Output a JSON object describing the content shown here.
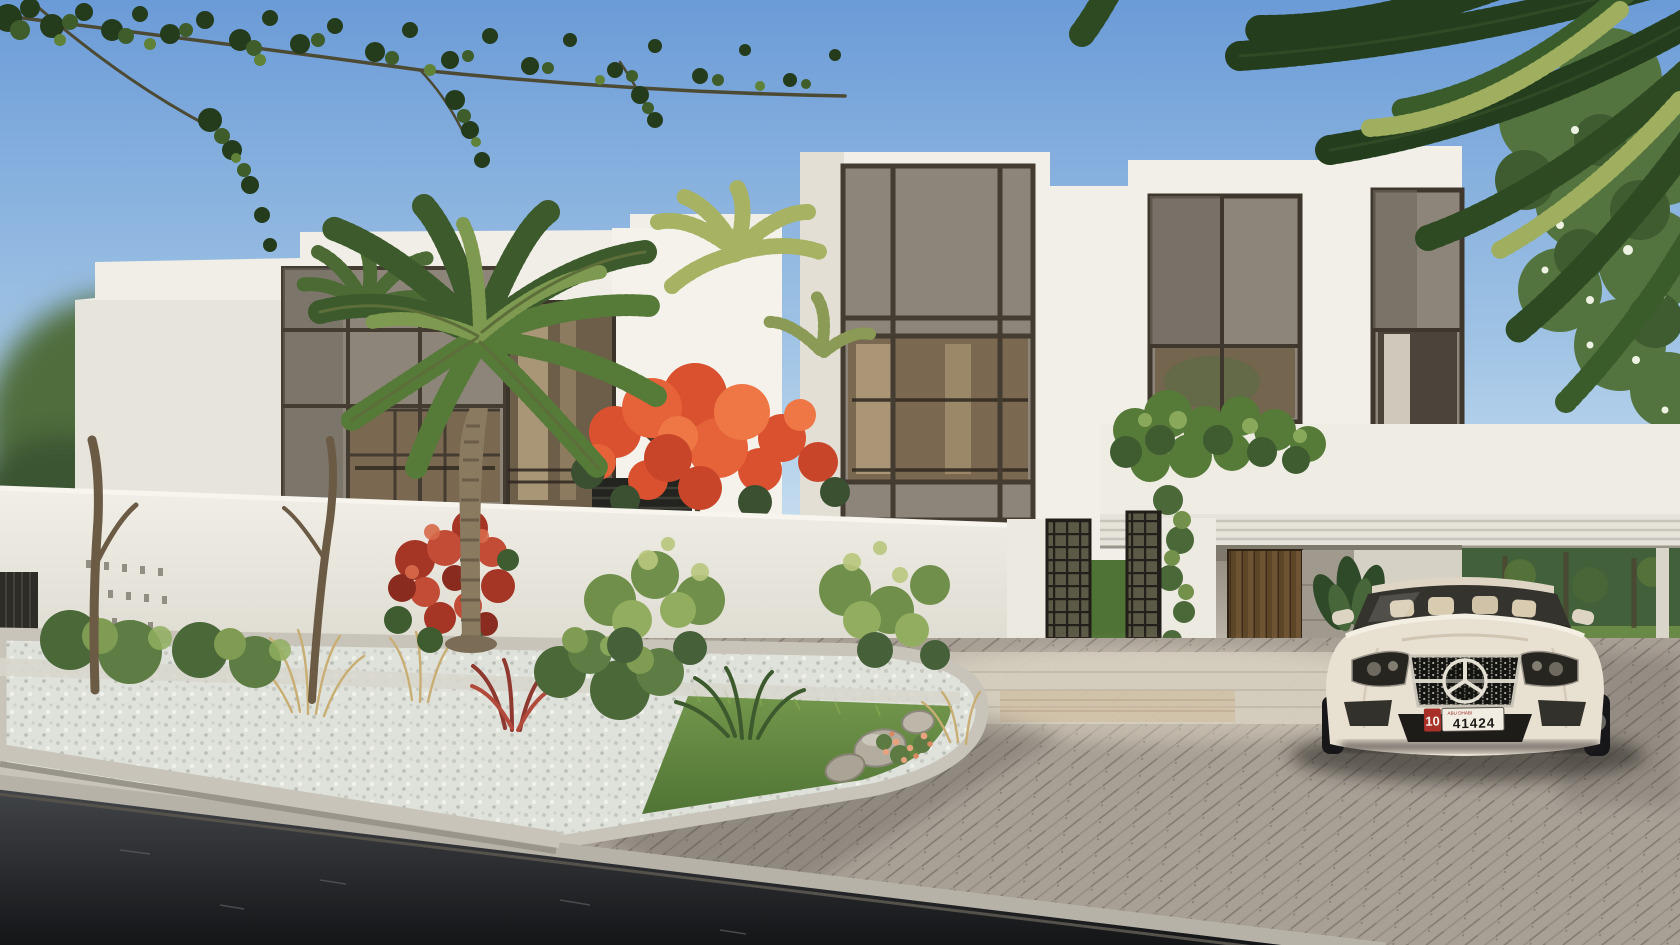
{
  "meta": {
    "title": "Villa community exterior rendering",
    "type": "photorealistic architectural render, street view, late-afternoon light"
  },
  "scene": {
    "elements": [
      "two modern two-storey white villas with grey stone panel and bronze mullion facades",
      "date palm and smaller palms",
      "royal poinciana tree with orange blossoms",
      "red bougainvillea on white perimeter wall",
      "bronze grid entrance gate",
      "carport with slatted timber door and potted plant",
      "white canopy over parking court",
      "white-gravel planting beds with grasses, cordyline, yucca and boulders",
      "herringbone paver driveway",
      "asphalt road with concrete curb",
      "white luxury sedan parked facing street"
    ]
  },
  "car": {
    "type": "luxury sedan, front three-quarter view",
    "brand_icon": "three-pointed-star",
    "body_color": "#e8e0d1",
    "plate": {
      "prefix": "10",
      "prefix_bg": "#a93028",
      "region": "ABU DHABI",
      "number": "41424"
    }
  },
  "palette": {
    "sky_top": "#6b9bd7",
    "sky_horizon": "#d3e6f2",
    "villa_white": "#f1eee7",
    "panel_gray": "#8d8579",
    "mullion": "#443b31",
    "glass_warm": "#7a6950",
    "wall_white": "#ebe9e1",
    "foliage_dark": "#2f4a26",
    "foliage_mid": "#55793c",
    "foliage_light": "#8fae5e",
    "flower_orange": "#e0512f",
    "flower_red": "#b53b2e",
    "gravel": "#dfe1db",
    "grass": "#5f8440",
    "paver": "#a89f95",
    "curb": "#c8c4b9",
    "asphalt": "#202225",
    "timber": "#6f5434",
    "gate_metal": "#23201b"
  }
}
